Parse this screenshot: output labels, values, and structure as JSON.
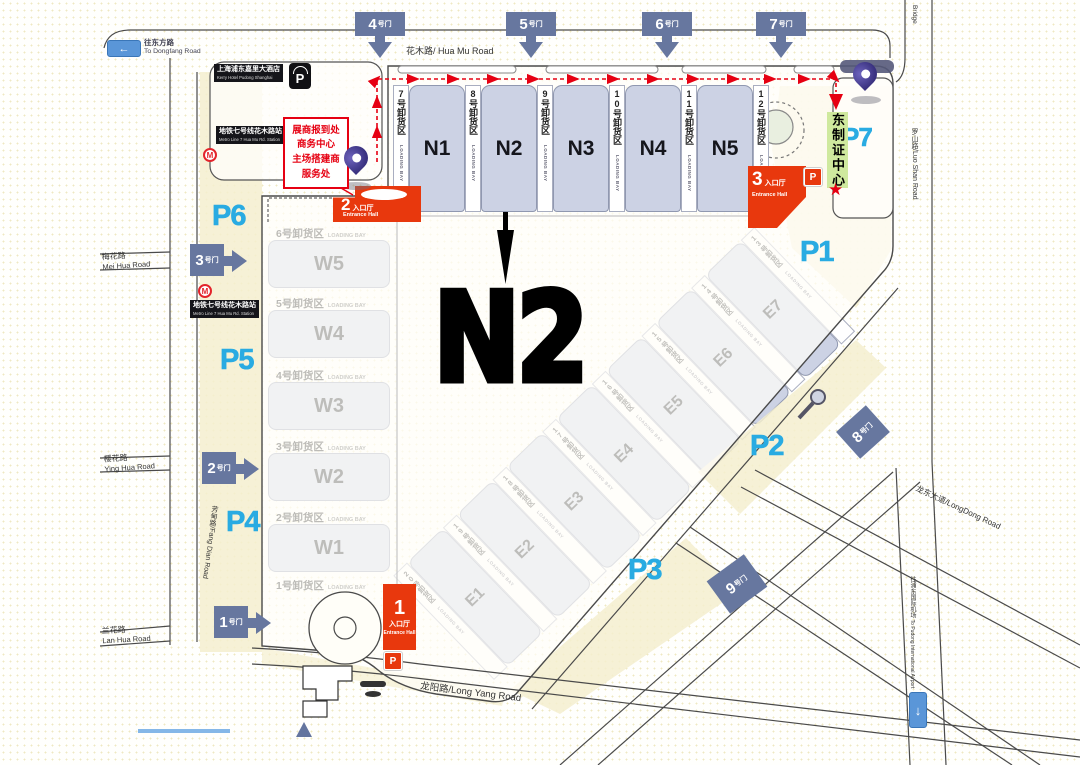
{
  "big_label": "N2",
  "halls": {
    "north": [
      "N1",
      "N2",
      "N3",
      "N4",
      "N5"
    ],
    "west": [
      "W5",
      "W4",
      "W3",
      "W2",
      "W1"
    ],
    "east": [
      "E1",
      "E2",
      "E3",
      "E4",
      "E5",
      "E6",
      "E7"
    ]
  },
  "bays": {
    "en": "LOADING BAY",
    "north": [
      "7号卸货区",
      "8号卸货区",
      "9号卸货区",
      "10号卸货区",
      "11号卸货区",
      "12号卸货区"
    ],
    "west": [
      "6号卸货区",
      "5号卸货区",
      "4号卸货区",
      "3号卸货区",
      "2号卸货区",
      "1号卸货区"
    ],
    "east": [
      "13号卸货区",
      "14号卸货区",
      "15号卸货区",
      "16号卸货区",
      "17号卸货区",
      "18号卸货区",
      "19号卸货区",
      "20号卸货区"
    ]
  },
  "gates": {
    "suffix": "号门",
    "top": [
      "4",
      "5",
      "6",
      "7"
    ],
    "left": [
      "3",
      "2",
      "1"
    ],
    "se": [
      "8",
      "9"
    ]
  },
  "parking": [
    "P1",
    "P2",
    "P3",
    "P4",
    "P5",
    "P6",
    "P7"
  ],
  "entrances": {
    "cn": "入口厅",
    "en": "Entrance Hall",
    "nums": [
      "1",
      "2",
      "3"
    ]
  },
  "roads": {
    "huamu": "花木路/ Hua Mu Road",
    "meihua_cn": "梅花路",
    "meihua_en": "Mei Hua Road",
    "yinghua_cn": "樱花路",
    "yinghua_en": "Ying Hua Road",
    "lanhua_cn": "兰花路",
    "lanhua_en": "Lan Hua Road",
    "fangdian": "芳甸路/Fang Dian Road",
    "longyang": "龙阳路/Long Yang Road",
    "longdong": "龙东大道/LongDong Road",
    "luoshan": "罗山路/Luo Shan Road",
    "bridge": "Bridge",
    "airport_cn": "往浦东国际机场",
    "airport_en": "To Pudong International Airport",
    "dongfang_cn": "往东方路",
    "dongfang_en": "To Dongfang Road"
  },
  "landmarks": {
    "hotel_cn": "上海浦东嘉里大酒店",
    "hotel_en": "Kerry Hotel Pudong Shanghai",
    "metro_cn": "地铁七号线花木路站",
    "metro_en": "Metro Line 7 Hua Mu Rd. Station",
    "badge_center": "东制证中心",
    "service_lines": [
      "展商报到处",
      "商务中心",
      "主场搭建商",
      "服务处"
    ]
  },
  "icons": {
    "parking": "P",
    "metro": "M",
    "star": "★",
    "down_arrow": "↓",
    "left_arrow": "←"
  },
  "colors": {
    "entrance_red": "#e8380d",
    "route_red": "#e60012",
    "gate_slate": "#67779f",
    "parking_cyan": "#29abe2",
    "hall_fill": "#ccd2e4",
    "badge_green": "#cfe99e",
    "pin_purple": "#3a3280"
  }
}
